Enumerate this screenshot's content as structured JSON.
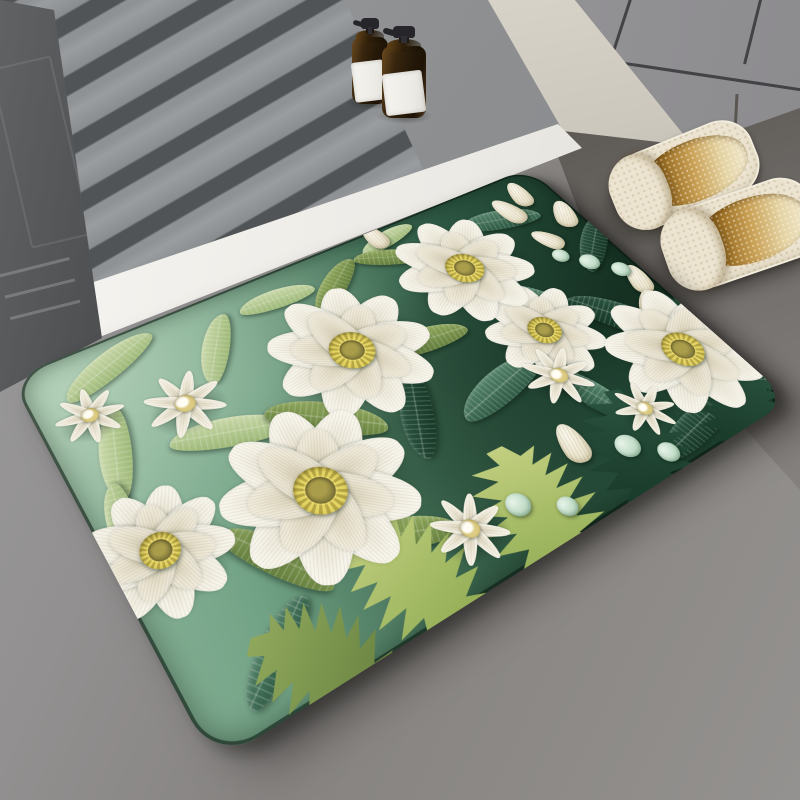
{
  "title": "3D white-flower quilled-paper pattern anti-slip bath mat — bathroom product photo",
  "scene": {
    "description": "Bathroom floor scene: gray slatted shower tray with two amber pump bottles at top, gray cabinet and beige wall at top right, a pair of cream woven slippers with amber gradient insoles on dark floor, and a large green mat with 3D paper-quilling style white flowers and layered green leaves lying diagonally across the floor.",
    "objects": [
      {
        "name": "shower-tray",
        "label": "gray slatted shower duckboard tray"
      },
      {
        "name": "dark-slab",
        "label": "dark gray embossed panel at left edge"
      },
      {
        "name": "threshold-strip",
        "label": "white threshold edge strip"
      },
      {
        "name": "wall",
        "label": "beige wall"
      },
      {
        "name": "cabinet",
        "label": "gray bathroom cabinet with panel seams"
      },
      {
        "name": "amber-bottle",
        "label": "amber glass pump bottle with blank white label",
        "count": 2
      },
      {
        "name": "slipper",
        "label": "cream woven slipper with amber gradient insole",
        "count": 2
      },
      {
        "name": "floral-mat",
        "label": "green bath mat with 3D white quilled flowers and leaves"
      }
    ]
  },
  "palette": {
    "floor": "#8f8d8b",
    "dark_floor": "#55514d",
    "tray": "#8e9092",
    "slat_gap": "#515456",
    "strip": "#f2f1ed",
    "wall": "#d9d4ca",
    "cabinet": "#98979b",
    "slab": "#57595b",
    "bottle_glass": "#2c1f10",
    "bottle_label": "#f3f2ee",
    "slipper": "#ece4d1",
    "insole_deep": "#6e4812",
    "mat_light": "#93ba9f",
    "mat_dark": "#1d4231",
    "petal": "#faf8f0",
    "center_yellow": "#d3c35a",
    "center_olive": "#8d8340",
    "mint_berry": "#cfe6d4"
  },
  "mat": {
    "flowers": [
      {
        "x": 545,
        "y": 233,
        "r": 70,
        "rot": 14
      },
      {
        "x": 525,
        "y": 108,
        "r": 85,
        "rot": 0
      },
      {
        "x": 334,
        "y": 147,
        "r": 92,
        "rot": 22
      },
      {
        "x": 46,
        "y": 258,
        "r": 68,
        "rot": -10
      },
      {
        "x": 208,
        "y": 280,
        "r": 98,
        "rot": 8
      },
      {
        "x": 668,
        "y": 336,
        "r": 90,
        "rot": -18
      }
    ],
    "daisies": [
      {
        "x": 52,
        "y": 85,
        "r": 36,
        "rot": 10
      },
      {
        "x": 142,
        "y": 120,
        "r": 44,
        "rot": -12
      },
      {
        "x": 514,
        "y": 291,
        "r": 42,
        "rot": 5
      },
      {
        "x": 567,
        "y": 374,
        "r": 36,
        "rot": 20
      },
      {
        "x": 310,
        "y": 390,
        "r": 40,
        "rot": -8
      }
    ],
    "leaves": [
      {
        "x": 95,
        "y": 35,
        "w": 120,
        "h": 34,
        "rot": -20,
        "p": "sage"
      },
      {
        "x": 205,
        "y": 70,
        "w": 100,
        "h": 30,
        "rot": -55,
        "p": "sage"
      },
      {
        "x": 300,
        "y": 40,
        "w": 95,
        "h": 28,
        "rot": 5,
        "p": "sage"
      },
      {
        "x": 55,
        "y": 140,
        "w": 110,
        "h": 32,
        "rot": -70,
        "p": "sage"
      },
      {
        "x": 165,
        "y": 175,
        "w": 125,
        "h": 36,
        "rot": 18,
        "p": "sage"
      },
      {
        "x": 28,
        "y": 215,
        "w": 90,
        "h": 28,
        "rot": -80,
        "p": "sage"
      },
      {
        "x": 470,
        "y": 20,
        "w": 84,
        "h": 24,
        "rot": -10,
        "p": "sage"
      },
      {
        "x": 260,
        "y": 210,
        "w": 130,
        "h": 40,
        "rot": 38,
        "p": "olive"
      },
      {
        "x": 410,
        "y": 175,
        "w": 115,
        "h": 34,
        "rot": 8,
        "p": "olive"
      },
      {
        "x": 370,
        "y": 55,
        "w": 100,
        "h": 30,
        "rot": -35,
        "p": "olive"
      },
      {
        "x": 135,
        "y": 320,
        "w": 120,
        "h": 36,
        "rot": 58,
        "p": "olive"
      },
      {
        "x": 250,
        "y": 360,
        "w": 115,
        "h": 34,
        "rot": 22,
        "p": "olive"
      },
      {
        "x": 455,
        "y": 48,
        "w": 90,
        "h": 26,
        "rot": 25,
        "p": "olive"
      },
      {
        "x": 450,
        "y": 270,
        "w": 130,
        "h": 40,
        "rot": -12,
        "p": "teal"
      },
      {
        "x": 555,
        "y": 180,
        "w": 120,
        "h": 38,
        "rot": 45,
        "p": "teal"
      },
      {
        "x": 620,
        "y": 62,
        "w": 110,
        "h": 34,
        "rot": 15,
        "p": "teal"
      },
      {
        "x": 90,
        "y": 395,
        "w": 110,
        "h": 32,
        "rot": -35,
        "p": "teal"
      },
      {
        "x": 530,
        "y": 330,
        "w": 112,
        "h": 34,
        "rot": 70,
        "p": "teal"
      },
      {
        "x": 640,
        "y": 262,
        "w": 130,
        "h": 42,
        "rot": 55,
        "p": "dark"
      },
      {
        "x": 680,
        "y": 395,
        "w": 130,
        "h": 40,
        "rot": 28,
        "p": "dark"
      },
      {
        "x": 600,
        "y": 420,
        "w": 120,
        "h": 36,
        "rot": -10,
        "p": "dark"
      },
      {
        "x": 700,
        "y": 152,
        "w": 110,
        "h": 34,
        "rot": -40,
        "p": "dark"
      },
      {
        "x": 345,
        "y": 255,
        "w": 110,
        "h": 36,
        "rot": -62,
        "p": "dark"
      }
    ],
    "ferns": [
      {
        "x": 235,
        "y": 405,
        "w": 150,
        "h": 160,
        "rot": -18,
        "p": "chart"
      },
      {
        "x": 380,
        "y": 415,
        "w": 165,
        "h": 170,
        "rot": 12,
        "p": "chart"
      },
      {
        "x": 120,
        "y": 428,
        "w": 135,
        "h": 140,
        "rot": -40,
        "p": "olive"
      },
      {
        "x": 520,
        "y": 410,
        "w": 155,
        "h": 160,
        "rot": 30,
        "p": "dark"
      },
      {
        "x": 665,
        "y": 428,
        "w": 140,
        "h": 145,
        "rot": 52,
        "p": "dark"
      },
      {
        "x": 702,
        "y": 300,
        "w": 115,
        "h": 120,
        "rot": 80,
        "p": "dark"
      }
    ],
    "buds": [
      {
        "x": 640,
        "y": 55,
        "w": 30,
        "h": 52,
        "rot": -15
      },
      {
        "x": 674,
        "y": 36,
        "w": 28,
        "h": 48,
        "rot": 8
      },
      {
        "x": 702,
        "y": 94,
        "w": 30,
        "h": 50,
        "rot": 24
      },
      {
        "x": 650,
        "y": 120,
        "w": 26,
        "h": 44,
        "rot": -30
      },
      {
        "x": 704,
        "y": 228,
        "w": 28,
        "h": 48,
        "rot": 15
      },
      {
        "x": 686,
        "y": 264,
        "w": 26,
        "h": 44,
        "rot": 40
      },
      {
        "x": 466,
        "y": 367,
        "w": 30,
        "h": 50,
        "rot": 10
      },
      {
        "x": 459,
        "y": 10,
        "w": 26,
        "h": 44,
        "rot": -5
      }
    ],
    "berries": [
      {
        "x": 670,
        "y": 176,
        "r": 13
      },
      {
        "x": 696,
        "y": 205,
        "r": 12
      },
      {
        "x": 645,
        "y": 150,
        "r": 11
      },
      {
        "x": 515,
        "y": 400,
        "r": 14
      },
      {
        "x": 548,
        "y": 428,
        "r": 12
      },
      {
        "x": 368,
        "y": 394,
        "r": 13
      },
      {
        "x": 410,
        "y": 421,
        "r": 11
      }
    ],
    "leaf_palettes": {
      "sage": [
        "#c9d8a8",
        "#9db878"
      ],
      "olive": [
        "#90a85c",
        "#657f3e"
      ],
      "teal": [
        "#55836a",
        "#2f5a44"
      ],
      "dark": [
        "#2b5440",
        "#173826"
      ],
      "chart": [
        "#c2cf80",
        "#8ca94f"
      ]
    }
  }
}
